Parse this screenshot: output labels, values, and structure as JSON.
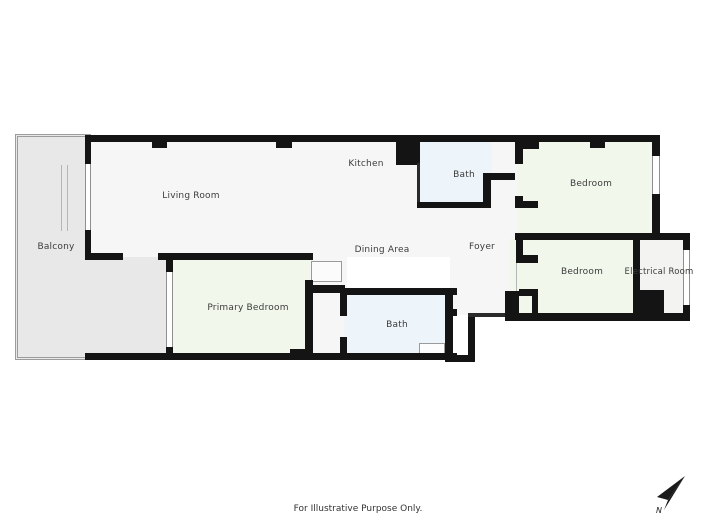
{
  "rooms": {
    "living_room": {
      "label": "Living Room"
    },
    "kitchen": {
      "label": "Kitchen"
    },
    "dining_area": {
      "label": "Dining Area"
    },
    "foyer": {
      "label": "Foyer"
    },
    "balcony": {
      "label": "Balcony"
    },
    "bath_top": {
      "label": "Bath"
    },
    "bath_bottom": {
      "label": "Bath"
    },
    "bedroom_top": {
      "label": "Bedroom"
    },
    "bedroom_bottom": {
      "label": "Bedroom"
    },
    "electrical_room": {
      "label": "Electrical Room"
    },
    "primary_bedroom": {
      "label": "Primary Bedroom"
    }
  },
  "footer": {
    "text": "For Illustrative Purpose Only."
  },
  "compass": {
    "north_label": "N"
  },
  "colors": {
    "wall": "#141414",
    "bedroom_fill": "#f2f7ec",
    "bath_fill": "#edf4fa",
    "balcony_fill": "#e8e8e8",
    "floor_fill": "#f6f6f6",
    "electrical_fill": "#f3f3f1",
    "label_text": "#3c3c3c"
  }
}
